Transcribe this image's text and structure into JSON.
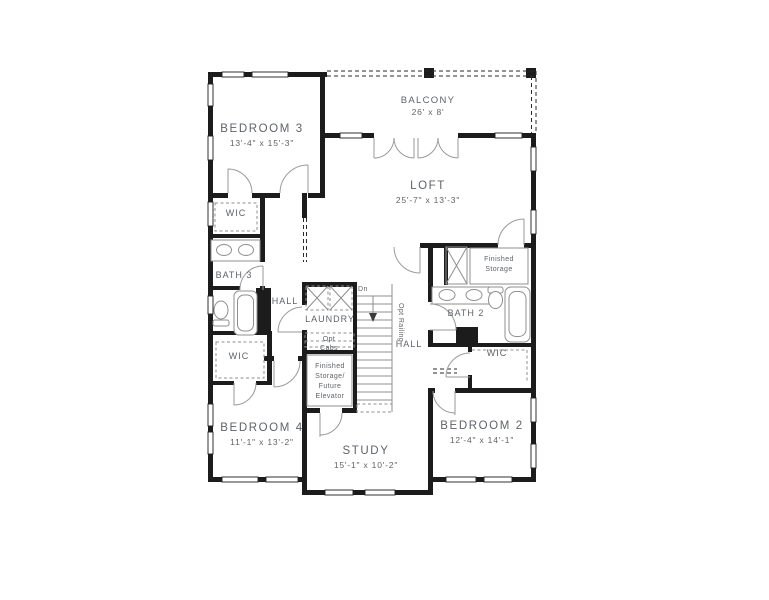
{
  "plan": {
    "rooms": {
      "bedroom3": {
        "label": "BEDROOM 3",
        "dims": "13'-4\" x 15'-3\""
      },
      "balcony": {
        "label": "BALCONY",
        "dims": "26' x 8'"
      },
      "loft": {
        "label": "LOFT",
        "dims": "25'-7\" x 13'-3\""
      },
      "wic3": {
        "label": "WIC"
      },
      "bath3": {
        "label": "BATH 3"
      },
      "hall_left": {
        "label": "HALL"
      },
      "laundry": {
        "label": "LAUNDRY"
      },
      "opt_cabs": {
        "lines": [
          "Opt",
          "Cabs"
        ]
      },
      "stairs": {
        "down_label": "Dn",
        "railing_label": "Opt Railing"
      },
      "hall_right": {
        "label": "HALL"
      },
      "storage_elevator": {
        "lines": [
          "Finished",
          "Storage/",
          "Future",
          "Elevator"
        ]
      },
      "finished_storage": {
        "lines": [
          "Finished",
          "Storage"
        ]
      },
      "bath2": {
        "label": "BATH 2"
      },
      "wic2": {
        "label": "WIC"
      },
      "wic4": {
        "label": "WIC"
      },
      "bedroom4": {
        "label": "BEDROOM 4",
        "dims": "11'-1\" x 13'-2\""
      },
      "study": {
        "label": "STUDY",
        "dims": "15'-1\" x 10'-2\""
      },
      "bedroom2": {
        "label": "BEDROOM 2",
        "dims": "12'-4\" x 14'-1\""
      }
    },
    "colors": {
      "wall": "#1c1c1c",
      "text": "#5f6368",
      "thin": "#8f8f8f",
      "background": "#ffffff"
    }
  }
}
